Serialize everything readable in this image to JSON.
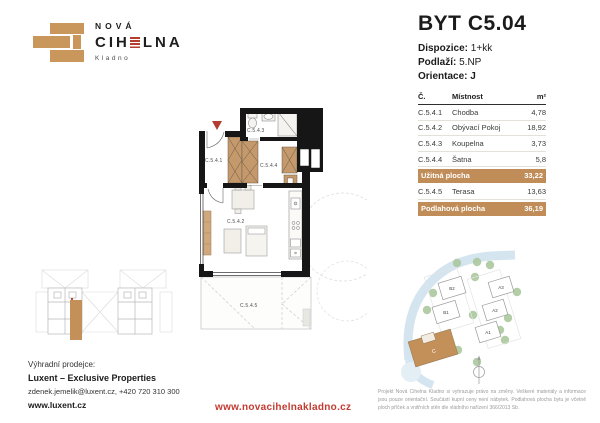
{
  "brand": {
    "line1": "NOVÁ",
    "name_pre": "CIH",
    "name_post": "LNA",
    "city": "Kladno"
  },
  "unit": {
    "title": "BYT C5.04",
    "dispozice_label": "Dispozice:",
    "dispozice_value": "1+kk",
    "podlazi_label": "Podlaží:",
    "podlazi_value": "5.NP",
    "orientace_label": "Orientace:",
    "orientace_value": "J"
  },
  "table": {
    "col_code": "Č.",
    "col_room": "Místnost",
    "col_area": "m²",
    "rows": [
      {
        "code": "C.5.4.1",
        "name": "Chodba",
        "area": "4,78"
      },
      {
        "code": "C.5.4.2",
        "name": "Obývací Pokoj",
        "area": "18,92"
      },
      {
        "code": "C.5.4.3",
        "name": "Koupelna",
        "area": "3,73"
      },
      {
        "code": "C.5.4.4",
        "name": "Šatna",
        "area": "5,8"
      }
    ],
    "usable": {
      "label": "Užitná plocha",
      "value": "33,22"
    },
    "terrace": {
      "code": "C.5.4.5",
      "name": "Terasa",
      "area": "13,63"
    },
    "floor": {
      "label": "Podlahová plocha",
      "value": "36,19"
    }
  },
  "plan": {
    "rooms": [
      "C.5.4.1",
      "C.5.4.3",
      "C.5.4.4",
      "C.5.4.2",
      "C.5.4.5"
    ]
  },
  "siteplan": {
    "buildings": [
      "B2",
      "B1",
      "A3",
      "A2",
      "A1"
    ],
    "highlight": "C"
  },
  "footer": {
    "seller_label": "Výhradní prodejce:",
    "seller_name": "Luxent – Exclusive Properties",
    "contact": "zdenek.jemelik@luxent.cz, +420 720 310 300",
    "seller_web": "www.luxent.cz",
    "project_web": "www.novacihelnakladno.cz",
    "disclaimer": "Projekt Nová Cihelna Kladno si vyhrazuje právo na změny. Veškeré materiály a informace jsou pouze orientační. Součástí kupní ceny není nábytek. Podlahová plocha bytu je včetně ploch příček a vnitřních stěn dle vládního nařízení 366/2013 Sb."
  },
  "colors": {
    "brand_tan": "#c3905a",
    "accent_red": "#b33d2f",
    "band_tan": "#c08d58"
  }
}
